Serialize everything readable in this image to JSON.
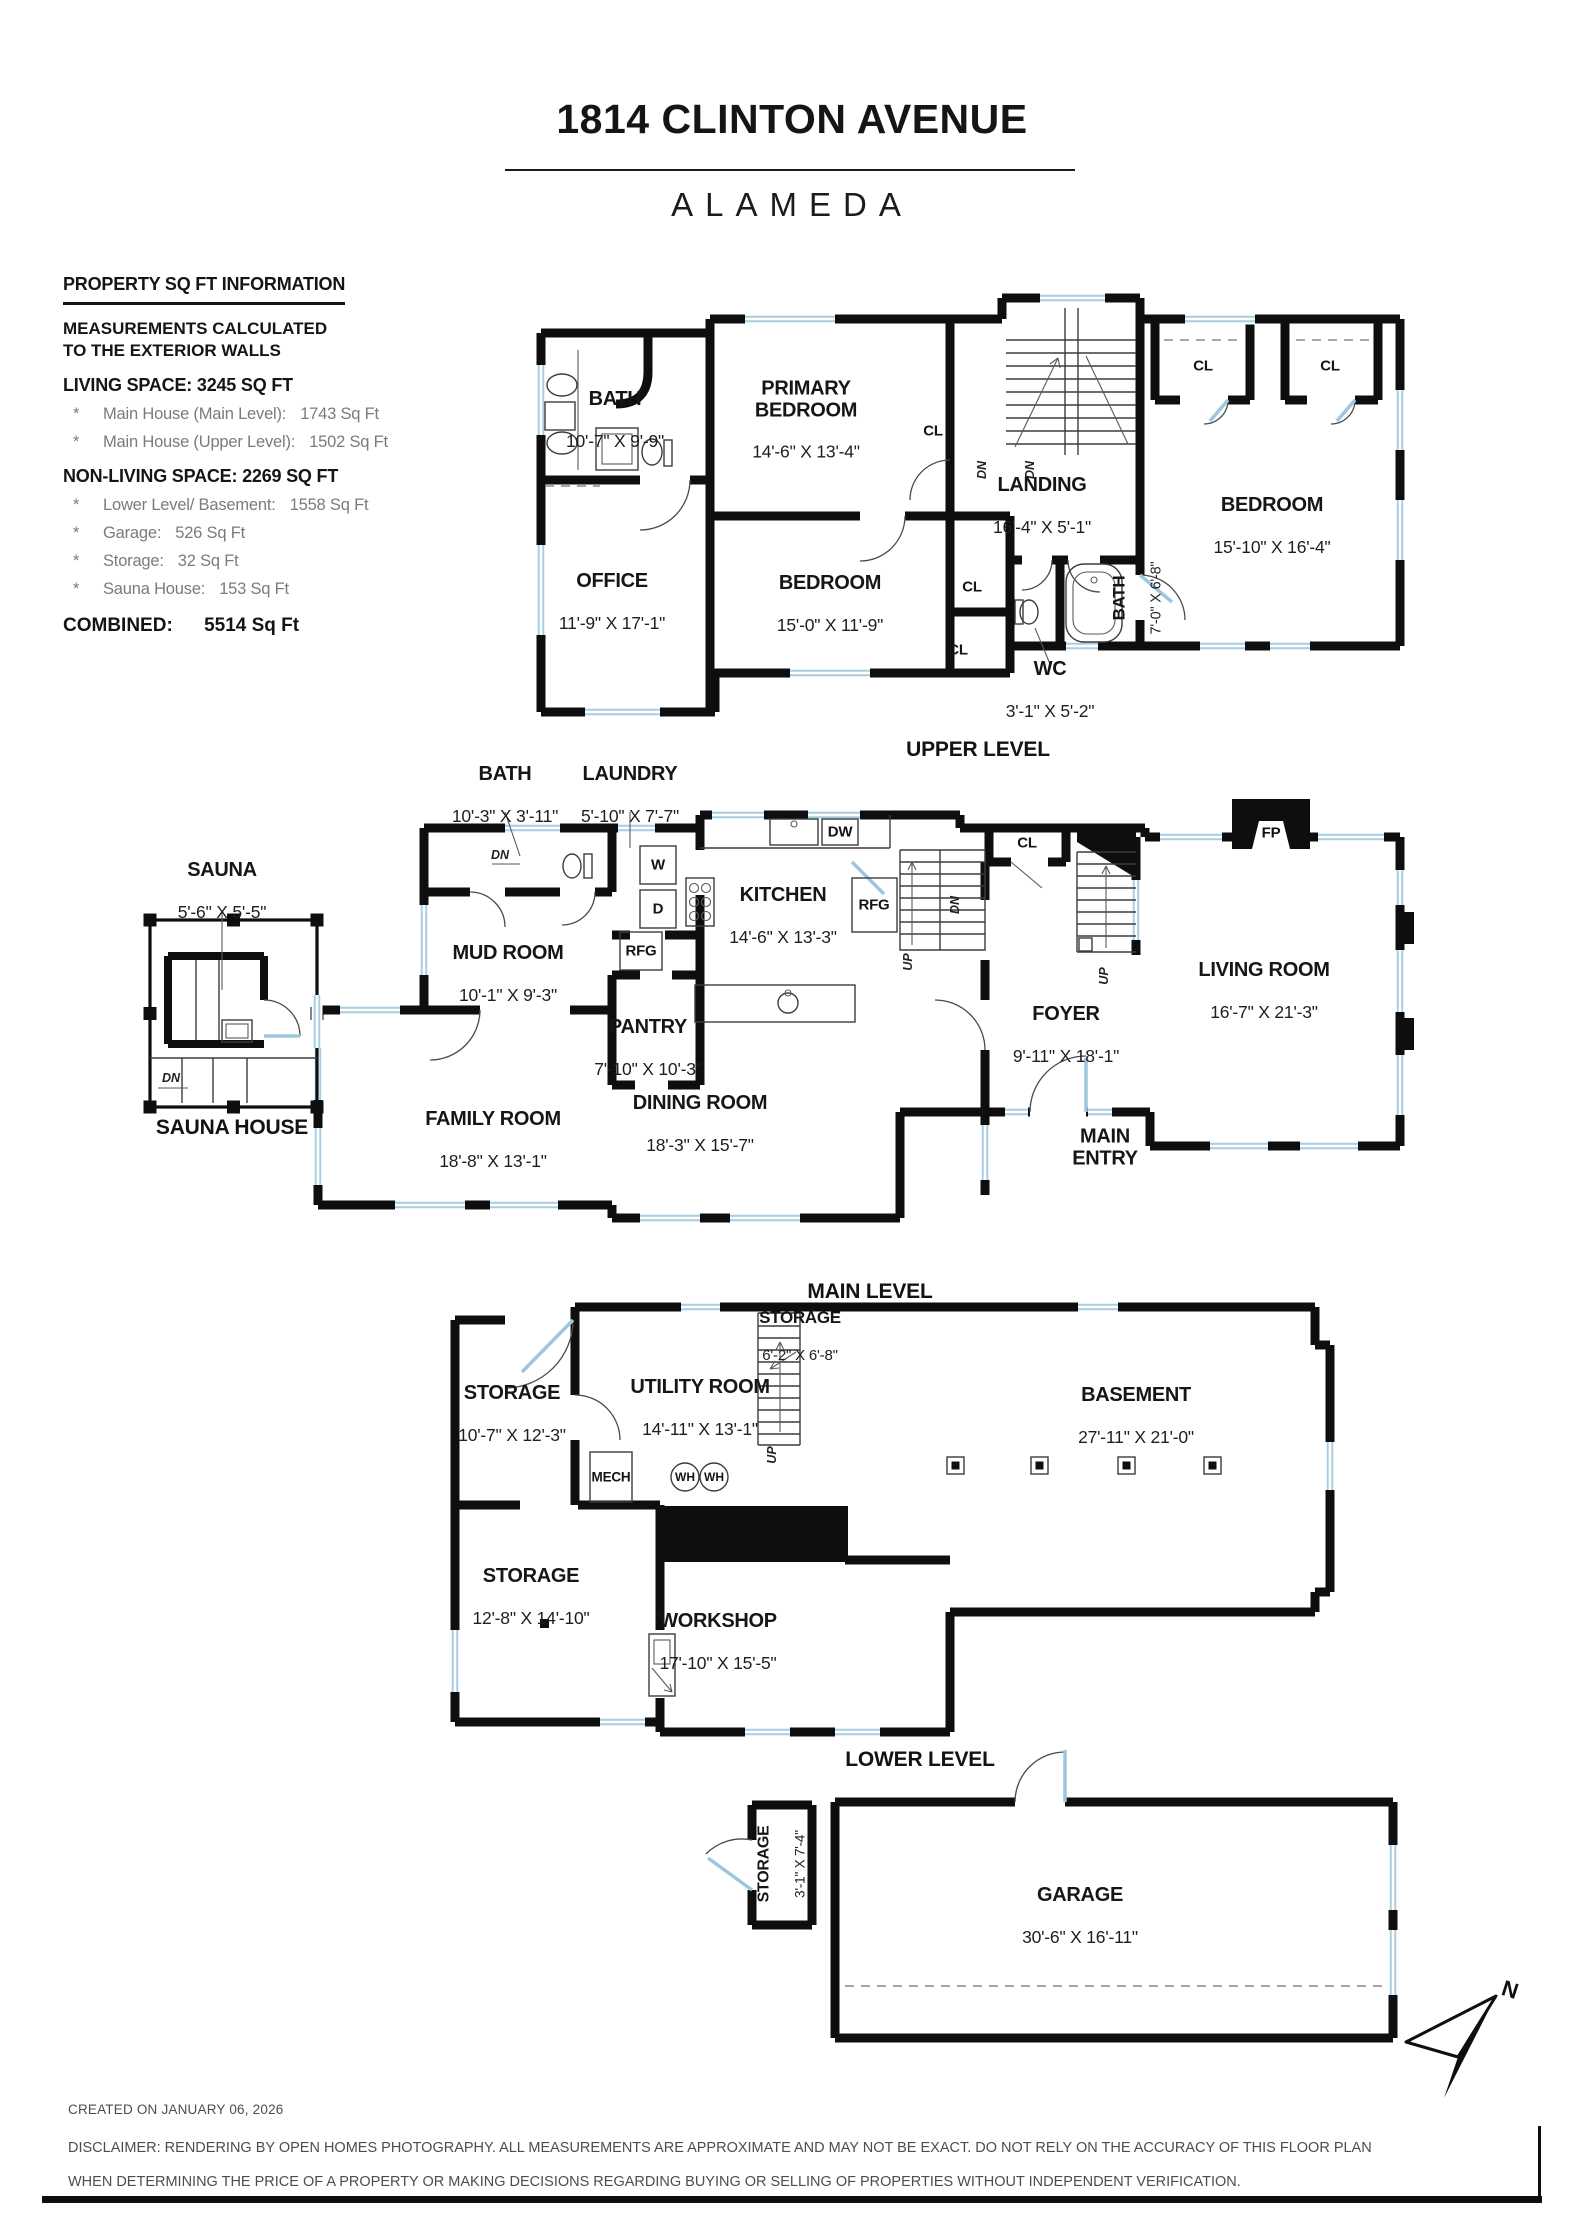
{
  "header": {
    "title": "1814 CLINTON AVENUE",
    "subtitle": "ALAMEDA"
  },
  "info": {
    "heading": "PROPERTY SQ FT INFORMATION",
    "note1": "MEASUREMENTS CALCULATED",
    "note2": "TO THE EXTERIOR WALLS",
    "living_heading": "LIVING SPACE: 3245 SQ FT",
    "living_items": [
      {
        "bullet": "*",
        "label": "Main House (Main Level):",
        "value": "1743 Sq Ft"
      },
      {
        "bullet": "*",
        "label": "Main House (Upper Level):",
        "value": "1502 Sq Ft"
      }
    ],
    "nonliving_heading": "NON-LIVING SPACE: 2269 SQ FT",
    "nonliving_items": [
      {
        "bullet": "*",
        "label": "Lower Level/ Basement:",
        "value": "1558 Sq Ft"
      },
      {
        "bullet": "*",
        "label": "Garage:",
        "value": "526 Sq Ft"
      },
      {
        "bullet": "*",
        "label": "Storage:",
        "value": "32 Sq Ft"
      },
      {
        "bullet": "*",
        "label": "Sauna House:",
        "value": "153 Sq Ft"
      }
    ],
    "combined_label": "COMBINED:",
    "combined_value": "5514  Sq Ft"
  },
  "upper": {
    "caption": "UPPER LEVEL",
    "bath": {
      "name": "BATH",
      "dims": "10'-7\" X 9'-9\""
    },
    "office": {
      "name": "OFFICE",
      "dims": "11'-9\" X 17'-1\""
    },
    "primary": {
      "name": "PRIMARY\nBEDROOM",
      "dims": "14'-6\" X 13'-4\""
    },
    "bedroom_mid": {
      "name": "BEDROOM",
      "dims": "15'-0\" X 11'-9\""
    },
    "landing": {
      "name": "LANDING",
      "dims": "16'-4\" X 5'-1\""
    },
    "bedroom_right": {
      "name": "BEDROOM",
      "dims": "15'-10\" X 16'-4\""
    },
    "wc": {
      "name": "WC",
      "dims": "3'-1\" X 5'-2\""
    },
    "bath2": {
      "name": "BATH",
      "dims": "7'-0\" X 6'-8\""
    },
    "cl": "CL",
    "dn": "DN"
  },
  "main": {
    "caption": "MAIN LEVEL",
    "bath": {
      "name": "BATH",
      "dims": "10'-3\" X 3'-11\""
    },
    "laundry": {
      "name": "LAUNDRY",
      "dims": "5'-10\" X 7'-7\""
    },
    "kitchen": {
      "name": "KITCHEN",
      "dims": "14'-6\" X 13'-3\""
    },
    "mudroom": {
      "name": "MUD ROOM",
      "dims": "10'-1\" X 9'-3\""
    },
    "pantry": {
      "name": "PANTRY",
      "dims": "7'-10\" X 10'-3\""
    },
    "family": {
      "name": "FAMILY ROOM",
      "dims": "18'-8\" X 13'-1\""
    },
    "dining": {
      "name": "DINING ROOM",
      "dims": "18'-3\" X 15'-7\""
    },
    "living": {
      "name": "LIVING ROOM",
      "dims": "16'-7\" X 21'-3\""
    },
    "foyer": {
      "name": "FOYER",
      "dims": "9'-11\" X 18'-1\""
    },
    "entry": {
      "name": "MAIN\nENTRY"
    },
    "labels": {
      "w": "W",
      "d": "D",
      "dw": "DW",
      "rfg": "RFG",
      "cl": "CL",
      "fp": "FP",
      "up": "UP",
      "dn": "DN"
    }
  },
  "lower": {
    "caption": "LOWER LEVEL",
    "storage_tl": {
      "name": "STORAGE",
      "dims": "10'-7\" X 12'-3\""
    },
    "utility": {
      "name": "UTILITY ROOM",
      "dims": "14'-11\" X 13'-1\""
    },
    "storage_tr": {
      "name": "STORAGE",
      "dims": "6'-2\" X 6'-8\""
    },
    "basement": {
      "name": "BASEMENT",
      "dims": "27'-11\" X 21'-0\""
    },
    "storage_bl": {
      "name": "STORAGE",
      "dims": "12'-8\" X 14'-10\""
    },
    "workshop": {
      "name": "WORKSHOP",
      "dims": "17'-10\" X 15'-5\""
    },
    "labels": {
      "mech": "MECH",
      "wh": "WH",
      "up": "UP"
    }
  },
  "garage_level": {
    "garage": {
      "name": "GARAGE",
      "dims": "30'-6\" X 16'-11\""
    },
    "storage": {
      "name": "STORAGE",
      "dims": "3'-1\" X 7'-4\""
    }
  },
  "sauna": {
    "caption": "SAUNA HOUSE",
    "room": {
      "name": "SAUNA",
      "dims": "5'-6\" X 5'-5\""
    },
    "dn": "DN"
  },
  "compass": {
    "n": "N"
  },
  "footer": {
    "created": "CREATED ON JANUARY 06, 2026",
    "disclaimer1": "DISCLAIMER: RENDERING BY OPEN HOMES PHOTOGRAPHY. ALL MEASUREMENTS ARE APPROXIMATE AND MAY NOT BE EXACT. DO NOT RELY ON THE ACCURACY OF THIS FLOOR PLAN",
    "disclaimer2": "WHEN DETERMINING THE PRICE OF A PROPERTY OR MAKING DECISIONS REGARDING BUYING OR SELLING OF PROPERTIES WITHOUT INDEPENDENT VERIFICATION."
  }
}
